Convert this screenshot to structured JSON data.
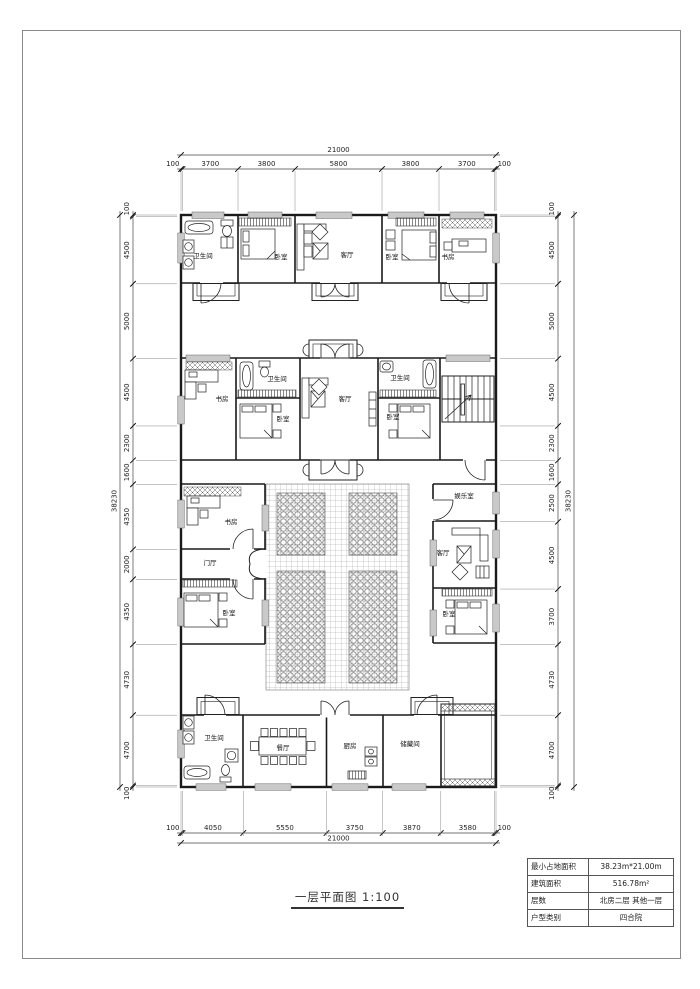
{
  "title_block": {
    "text": "一层平面图",
    "scale": "1:100"
  },
  "info_table": {
    "rows": [
      {
        "label": "最小占地面积",
        "value": "38.23m*21.00m"
      },
      {
        "label": "建筑面积",
        "value": "516.78m²"
      },
      {
        "label": "层数",
        "value": "北房二层 其他一层"
      },
      {
        "label": "户型类别",
        "value": "四合院"
      }
    ]
  },
  "dimensions": {
    "top": {
      "total": "21000",
      "segments": [
        100,
        3700,
        3800,
        5800,
        3800,
        3700,
        100
      ]
    },
    "bottom": {
      "total": "21000",
      "segments": [
        100,
        4050,
        5550,
        3750,
        3870,
        3580,
        100
      ]
    },
    "left": {
      "total": "38230",
      "segments": [
        100,
        4500,
        5000,
        4500,
        2300,
        1600,
        4350,
        2000,
        4350,
        4730,
        4700,
        100
      ]
    },
    "right": {
      "total": "38230",
      "segments": [
        100,
        4500,
        5000,
        4500,
        2300,
        1600,
        2500,
        4500,
        3700,
        4730,
        4700,
        100
      ]
    }
  },
  "room_labels": [
    {
      "room": "bathroom-north",
      "label": "卫生间",
      "x": 203,
      "y": 258
    },
    {
      "room": "bedroom-north-1",
      "label": "卧室",
      "x": 281,
      "y": 259
    },
    {
      "room": "living-north",
      "label": "客厅",
      "x": 347,
      "y": 257
    },
    {
      "room": "bedroom-north-2",
      "label": "卧室",
      "x": 392,
      "y": 259
    },
    {
      "room": "study-north",
      "label": "书房",
      "x": 448,
      "y": 259
    },
    {
      "room": "study-mid",
      "label": "书房",
      "x": 222,
      "y": 401
    },
    {
      "room": "bathroom-mid-1",
      "label": "卫生间",
      "x": 277,
      "y": 381
    },
    {
      "room": "bedroom-mid-1",
      "label": "卧室",
      "x": 283,
      "y": 421
    },
    {
      "room": "living-mid",
      "label": "客厅",
      "x": 345,
      "y": 401
    },
    {
      "room": "bathroom-mid-2",
      "label": "卫生间",
      "x": 400,
      "y": 380
    },
    {
      "room": "bedroom-mid-2",
      "label": "卧室",
      "x": 393,
      "y": 419
    },
    {
      "room": "study-west",
      "label": "书房",
      "x": 231,
      "y": 524
    },
    {
      "room": "entry-hall-west",
      "label": "门厅",
      "x": 210,
      "y": 565
    },
    {
      "room": "bedroom-west",
      "label": "卧室",
      "x": 229,
      "y": 615
    },
    {
      "room": "recreation-east",
      "label": "娱乐室",
      "x": 464,
      "y": 498
    },
    {
      "room": "living-east",
      "label": "客厅",
      "x": 443,
      "y": 555
    },
    {
      "room": "bedroom-east",
      "label": "卧室",
      "x": 449,
      "y": 616
    },
    {
      "room": "bathroom-south",
      "label": "卫生间",
      "x": 214,
      "y": 740
    },
    {
      "room": "dining-south",
      "label": "餐厅",
      "x": 283,
      "y": 750
    },
    {
      "room": "kitchen-south",
      "label": "厨房",
      "x": 350,
      "y": 748
    },
    {
      "room": "storage-south",
      "label": "储藏间",
      "x": 410,
      "y": 746
    }
  ],
  "colors": {
    "line": "#1a1a1a",
    "dim": "#333333",
    "window_fill": "#c9c9c9",
    "border": "#8a8a8a"
  }
}
